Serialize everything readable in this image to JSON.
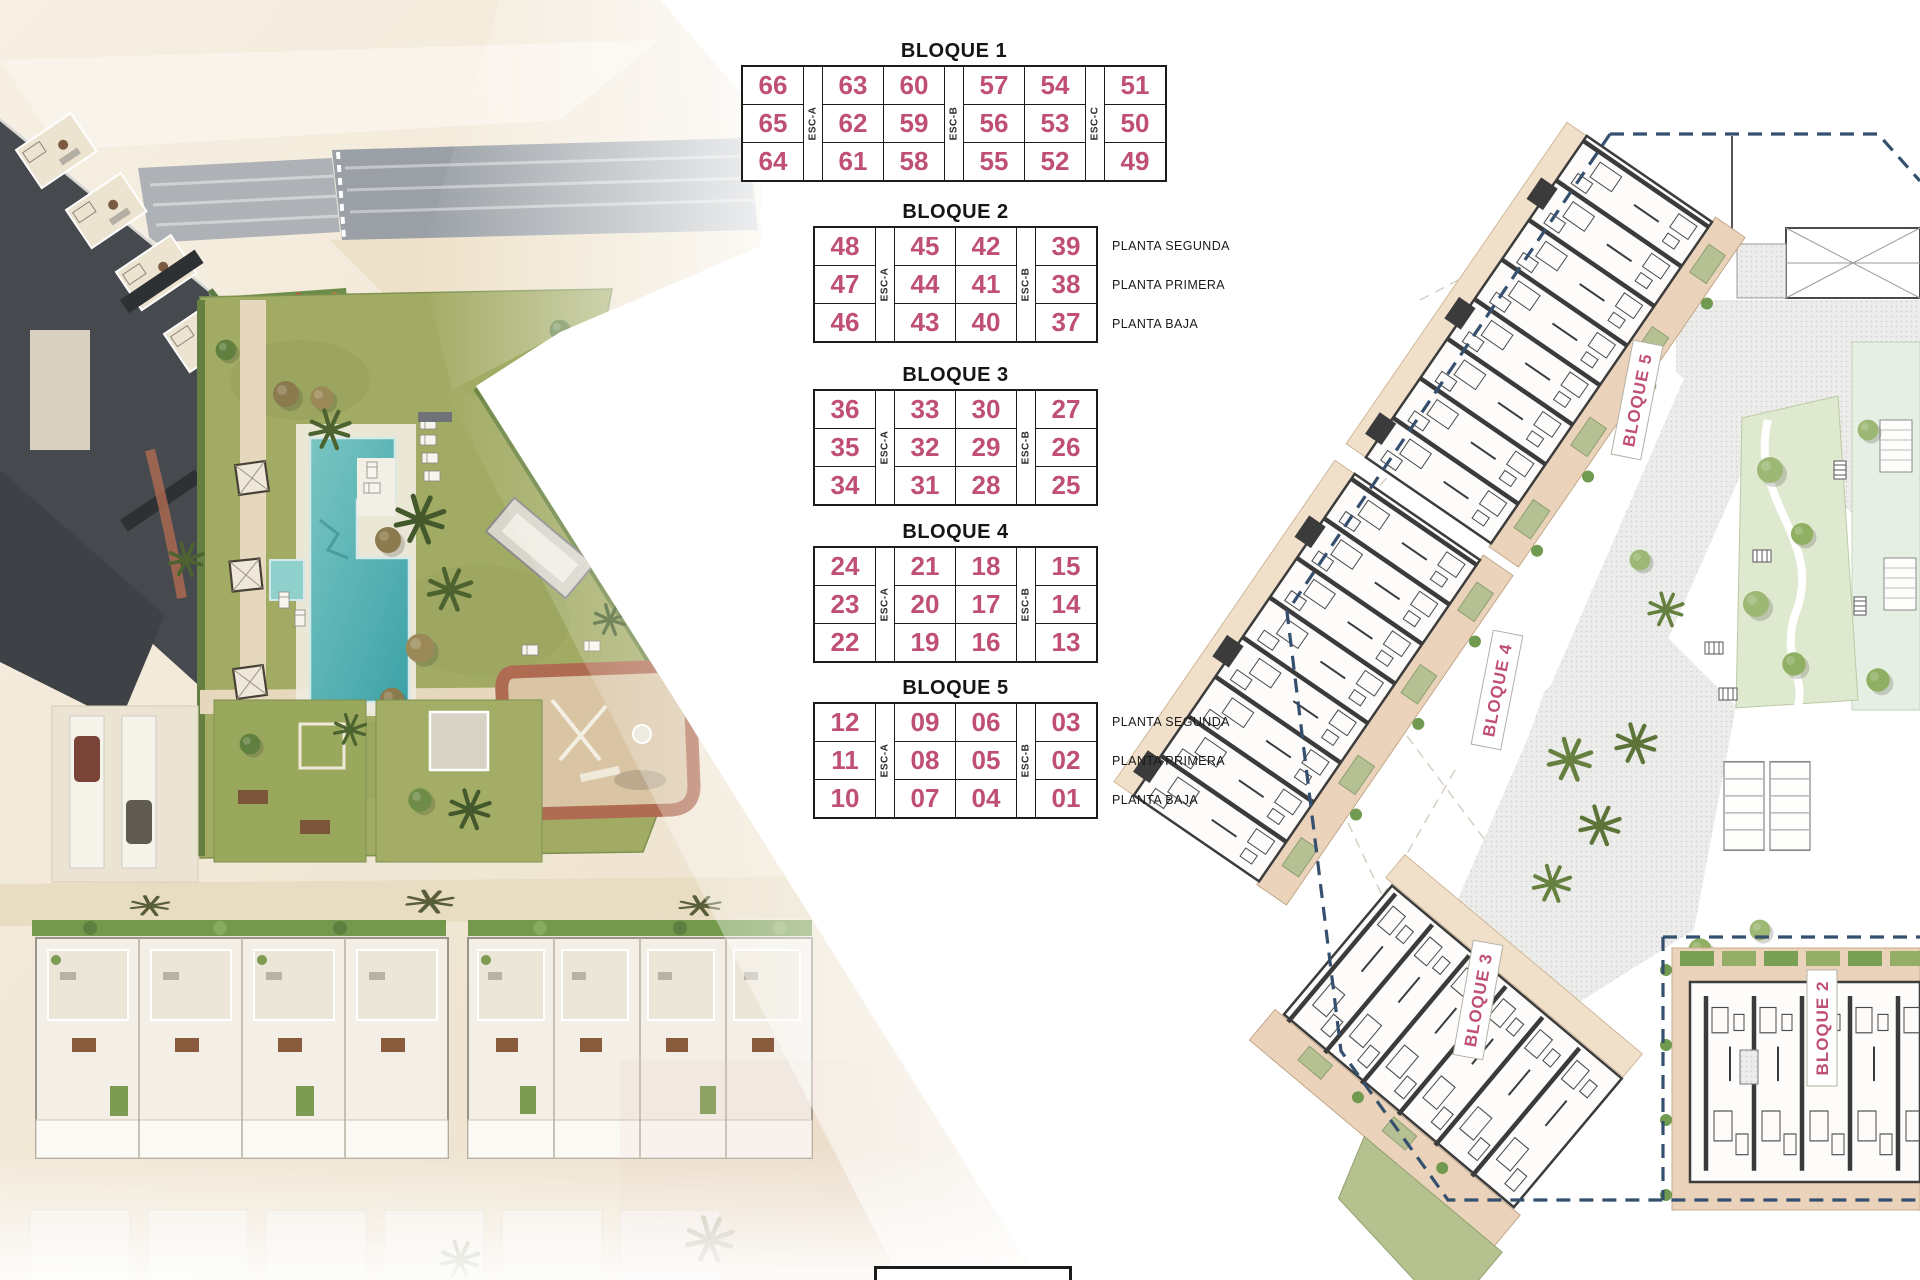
{
  "colors": {
    "accent_pink": "#bf4f77",
    "boundary_navy": "#35506f",
    "table_border": "#1c1c1c",
    "pool_teal": "#5cb7b5",
    "lawn_olive": "#a2ab64",
    "terrace_tan": "#ead3ba"
  },
  "tables": [
    {
      "title": "BLOQUE 1",
      "columns": [
        {
          "type": "units",
          "values": [
            "66",
            "65",
            "64"
          ]
        },
        {
          "type": "esc",
          "label": "ESC-A"
        },
        {
          "type": "units",
          "values": [
            "63",
            "62",
            "61"
          ]
        },
        {
          "type": "units",
          "values": [
            "60",
            "59",
            "58"
          ]
        },
        {
          "type": "esc",
          "label": "ESC-B"
        },
        {
          "type": "units",
          "values": [
            "57",
            "56",
            "55"
          ]
        },
        {
          "type": "units",
          "values": [
            "54",
            "53",
            "52"
          ]
        },
        {
          "type": "esc",
          "label": "ESC-C"
        },
        {
          "type": "units",
          "values": [
            "51",
            "50",
            "49"
          ]
        }
      ],
      "planta_labels": []
    },
    {
      "title": "BLOQUE 2",
      "columns": [
        {
          "type": "units",
          "values": [
            "48",
            "47",
            "46"
          ]
        },
        {
          "type": "esc",
          "label": "ESC-A"
        },
        {
          "type": "units",
          "values": [
            "45",
            "44",
            "43"
          ]
        },
        {
          "type": "units",
          "values": [
            "42",
            "41",
            "40"
          ]
        },
        {
          "type": "esc",
          "label": "ESC-B"
        },
        {
          "type": "units",
          "values": [
            "39",
            "38",
            "37"
          ]
        }
      ],
      "planta_labels": [
        "PLANTA SEGUNDA",
        "PLANTA PRIMERA",
        "PLANTA BAJA"
      ]
    },
    {
      "title": "BLOQUE 3",
      "columns": [
        {
          "type": "units",
          "values": [
            "36",
            "35",
            "34"
          ]
        },
        {
          "type": "esc",
          "label": "ESC-A"
        },
        {
          "type": "units",
          "values": [
            "33",
            "32",
            "31"
          ]
        },
        {
          "type": "units",
          "values": [
            "30",
            "29",
            "28"
          ]
        },
        {
          "type": "esc",
          "label": "ESC-B"
        },
        {
          "type": "units",
          "values": [
            "27",
            "26",
            "25"
          ]
        }
      ],
      "planta_labels": []
    },
    {
      "title": "BLOQUE 4",
      "columns": [
        {
          "type": "units",
          "values": [
            "24",
            "23",
            "22"
          ]
        },
        {
          "type": "esc",
          "label": "ESC-A"
        },
        {
          "type": "units",
          "values": [
            "21",
            "20",
            "19"
          ]
        },
        {
          "type": "units",
          "values": [
            "18",
            "17",
            "16"
          ]
        },
        {
          "type": "esc",
          "label": "ESC-B"
        },
        {
          "type": "units",
          "values": [
            "15",
            "14",
            "13"
          ]
        }
      ],
      "planta_labels": []
    },
    {
      "title": "BLOQUE 5",
      "columns": [
        {
          "type": "units",
          "values": [
            "12",
            "11",
            "10"
          ]
        },
        {
          "type": "esc",
          "label": "ESC-A"
        },
        {
          "type": "units",
          "values": [
            "09",
            "08",
            "07"
          ]
        },
        {
          "type": "units",
          "values": [
            "06",
            "05",
            "04"
          ]
        },
        {
          "type": "esc",
          "label": "ESC-B"
        },
        {
          "type": "units",
          "values": [
            "03",
            "02",
            "01"
          ]
        }
      ],
      "planta_labels": [
        "PLANTA SEGUNDA",
        "PLANTA PRIMERA",
        "PLANTA BAJA"
      ]
    }
  ],
  "plan": {
    "labels": [
      {
        "text": "BLOQUE 5"
      },
      {
        "text": "BLOQUE 4"
      },
      {
        "text": "BLOQUE 3"
      },
      {
        "text": "BLOQUE 2"
      }
    ]
  }
}
